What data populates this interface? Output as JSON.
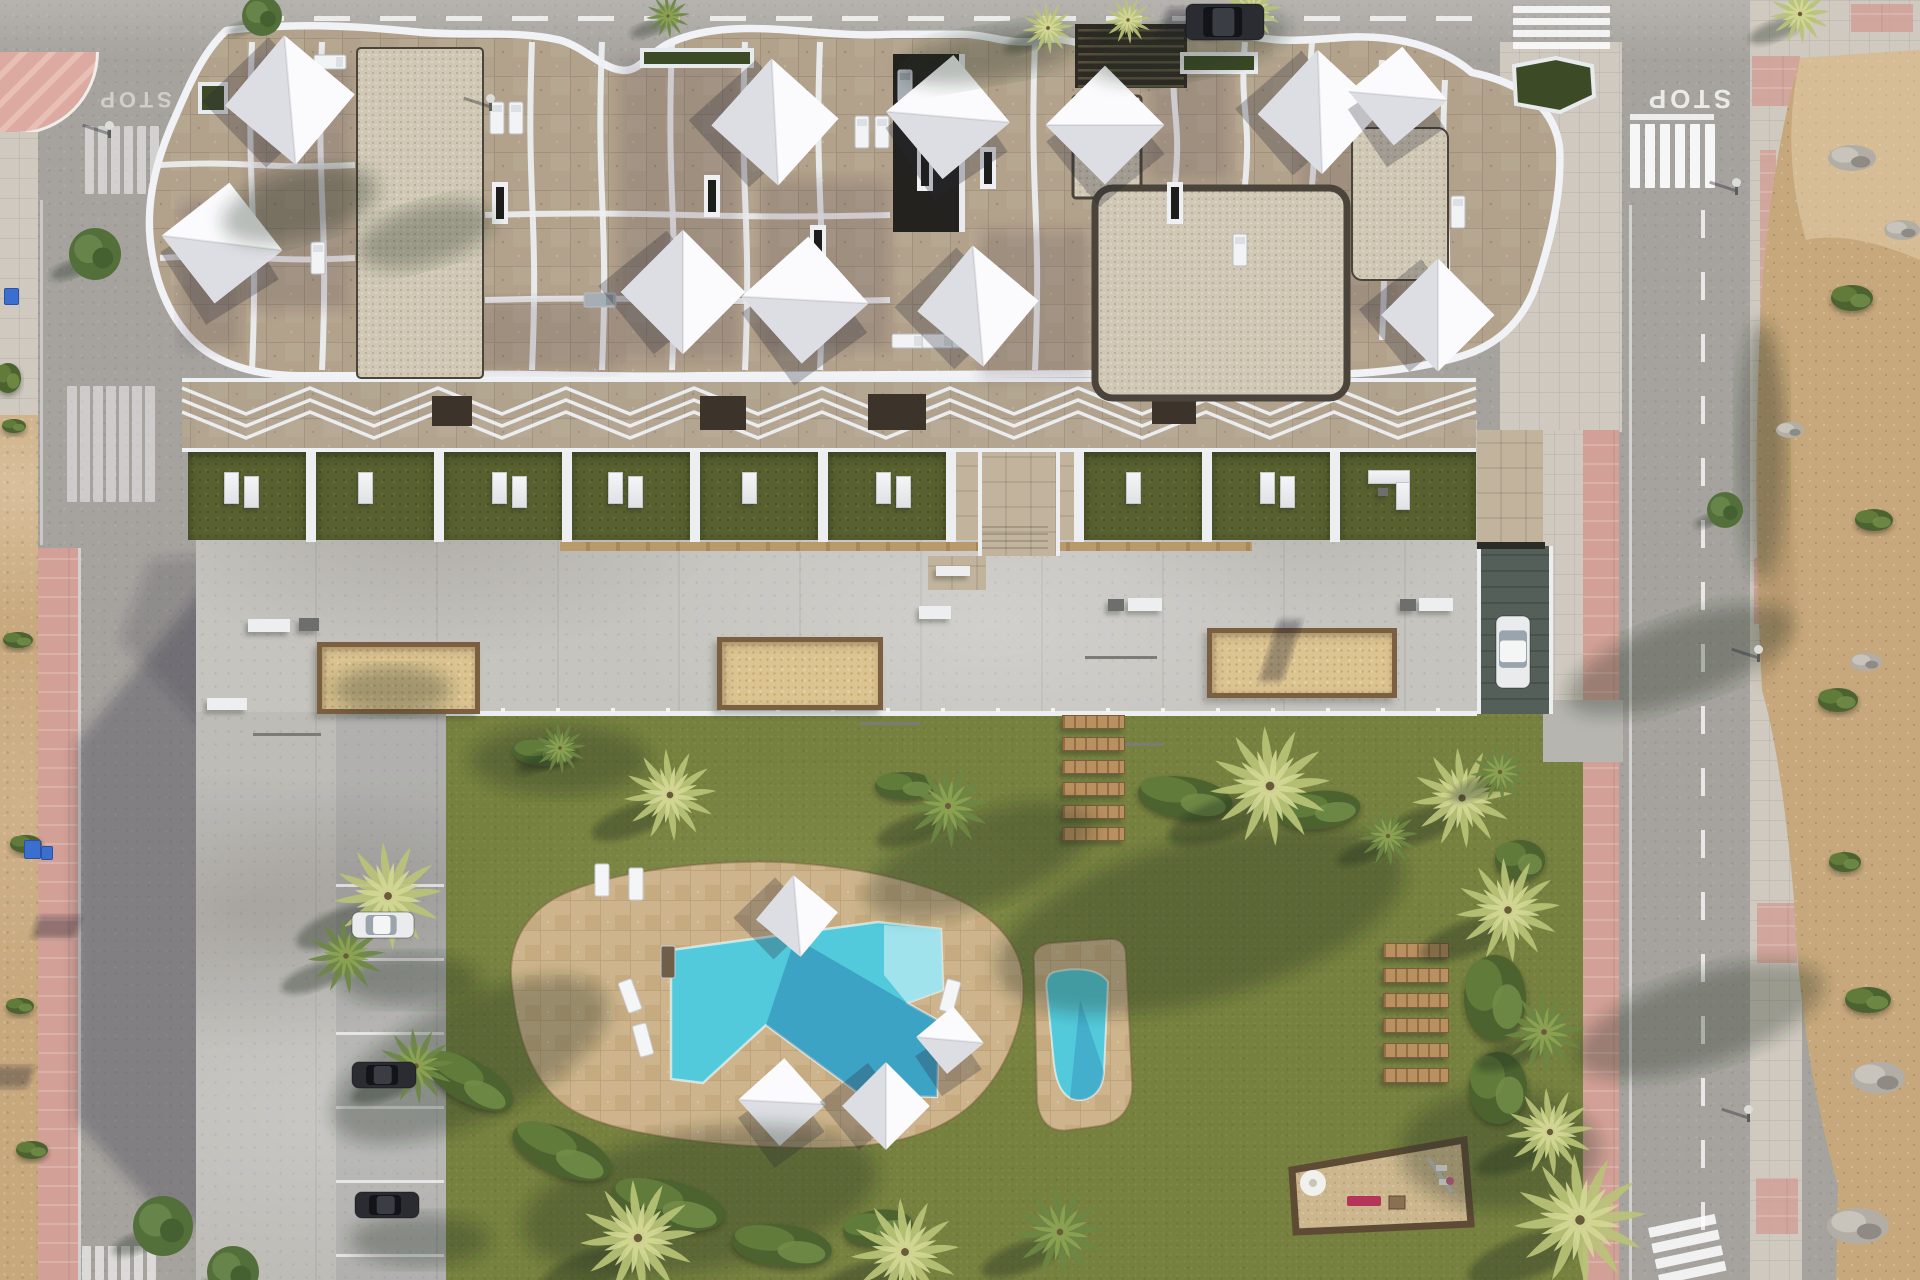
{
  "scene": {
    "title": "Aerial top-down architectural render: apartment building with rooftop terraces, communal garden, pools, petanque courts, parking and perimeter streets",
    "time_of_day": "sunny, shadows cast to lower-left"
  },
  "palette": {
    "asphalt": "#a6a39e",
    "deck_concrete": "#c6c4bf",
    "stone_terrace": "#b2a28b",
    "gravel": "#d0c8b5",
    "lawn": "#76813f",
    "private_garden": "#586030",
    "pool_water": "#53cadb",
    "pool_water_shadow": "#1f6da8",
    "pool_shallow": "#a9e6ee",
    "pool_deck": "#cdb48c",
    "pink_sidewalk": "#d2a096",
    "pale_sidewalk": "#cfc9c0",
    "dirt": "#c7a87c",
    "wood": "#b9905f",
    "parapet_white": "#f0f2f5",
    "sail_white": "#fbfbfd",
    "court_sand": "#dcc491",
    "playground_sand": "#ccb68d"
  },
  "roads": {
    "stop_marking": "STOP",
    "stops": [
      {
        "x": 134,
        "y": 92,
        "rot": 180,
        "size": 22,
        "op": 0.55
      },
      {
        "x": 1688,
        "y": 90,
        "rot": 180,
        "size": 26,
        "op": 0.9
      }
    ],
    "dashes_top": {
      "y": 16,
      "x0": 248,
      "x1": 1490,
      "w": 36,
      "h": 5,
      "gap": 30,
      "op": 0.75
    },
    "dashes_right": {
      "x": 1701,
      "y0": 210,
      "y1": 1225,
      "w": 4,
      "h": 28,
      "gap": 34,
      "op": 0.75
    },
    "edge_lines": [
      {
        "x": 1629,
        "y": 205,
        "w": 3,
        "h": 1075,
        "op": 0.5
      },
      {
        "x": 229,
        "y": 430,
        "w": 3,
        "h": 850,
        "op": 0.35
      },
      {
        "x": 40,
        "y": 200,
        "w": 3,
        "h": 345,
        "op": 0.4
      },
      {
        "x": 1630,
        "y": 114,
        "w": 84,
        "h": 6,
        "op": 0.8
      }
    ],
    "crosswalks": [
      {
        "x": 85,
        "y": 126,
        "n": 6,
        "w": 9,
        "h": 68,
        "gap": 4,
        "vert": true,
        "op": 0.5,
        "rot": 0
      },
      {
        "x": 67,
        "y": 386,
        "n": 7,
        "w": 10,
        "h": 116,
        "gap": 3,
        "vert": true,
        "op": 0.45,
        "rot": 0
      },
      {
        "x": 82,
        "y": 1246,
        "n": 6,
        "w": 9,
        "h": 34,
        "gap": 4,
        "vert": true,
        "op": 0.6,
        "rot": 0
      },
      {
        "x": 1630,
        "y": 124,
        "n": 6,
        "w": 10,
        "h": 64,
        "gap": 5,
        "vert": true,
        "op": 0.9,
        "rot": 0
      },
      {
        "x": 1513,
        "y": 6,
        "n": 4,
        "w": 97,
        "h": 7,
        "gap": 5,
        "vert": false,
        "op": 0.85,
        "rot": 0
      },
      {
        "x": 1648,
        "y": 1228,
        "n": 4,
        "w": 68,
        "h": 10,
        "gap": 6,
        "vert": false,
        "op": 0.85,
        "rot": -12
      }
    ]
  },
  "building": {
    "gravel_patches": [
      {
        "x": 357,
        "y": 48,
        "w": 126,
        "h": 330,
        "r": 4,
        "border": 2
      },
      {
        "x": 1073,
        "y": 96,
        "w": 68,
        "h": 102,
        "r": 3,
        "border": 3
      },
      {
        "x": 1095,
        "y": 188,
        "w": 252,
        "h": 210,
        "r": 18,
        "border": 7
      },
      {
        "x": 1352,
        "y": 128,
        "w": 96,
        "h": 152,
        "r": 10,
        "border": 2
      }
    ],
    "shade_quads": [
      [
        250,
        60,
        100,
        250
      ],
      [
        620,
        60,
        120,
        300
      ],
      [
        760,
        180,
        130,
        170
      ],
      [
        1150,
        60,
        80,
        120
      ],
      [
        1300,
        120,
        100,
        200
      ],
      [
        420,
        300,
        200,
        70
      ],
      [
        180,
        200,
        60,
        150
      ],
      [
        980,
        230,
        110,
        150
      ]
    ],
    "wavy_walls_x": [
      252,
      322,
      532,
      602,
      672,
      745,
      820,
      1035,
      1105,
      1175,
      1245,
      1312,
      1382,
      1445
    ],
    "wavy_walls_h": [
      [
        252,
        42,
        370
      ],
      [
        322,
        42,
        370
      ],
      [
        532,
        42,
        370
      ],
      [
        602,
        42,
        370
      ],
      [
        672,
        42,
        370
      ],
      [
        745,
        42,
        370
      ],
      [
        820,
        42,
        370
      ],
      [
        1035,
        42,
        370
      ],
      [
        1105,
        42,
        185
      ],
      [
        1175,
        42,
        185
      ],
      [
        1245,
        42,
        185
      ],
      [
        1312,
        42,
        185
      ],
      [
        1382,
        60,
        340
      ],
      [
        1445,
        80,
        330
      ]
    ],
    "horiz_walls": [
      [
        160,
        355,
        165
      ],
      [
        160,
        355,
        258
      ],
      [
        485,
        890,
        215
      ],
      [
        485,
        890,
        300
      ]
    ],
    "roof_sails": [
      [
        290,
        100,
        92,
        40
      ],
      [
        222,
        243,
        86,
        -38
      ],
      [
        775,
        122,
        90,
        42
      ],
      [
        948,
        117,
        88,
        -40
      ],
      [
        683,
        292,
        88,
        45
      ],
      [
        805,
        300,
        90,
        -42
      ],
      [
        978,
        306,
        86,
        40
      ],
      [
        1105,
        125,
        84,
        -45
      ],
      [
        1320,
        112,
        88,
        43
      ],
      [
        1398,
        96,
        70,
        -40
      ],
      [
        1438,
        315,
        80,
        45
      ]
    ],
    "roof_loungers": [
      [
        497,
        118,
        0,
        0
      ],
      [
        516,
        118,
        0,
        0
      ],
      [
        862,
        132,
        0,
        0
      ],
      [
        882,
        132,
        0,
        0
      ],
      [
        905,
        86,
        0,
        1
      ],
      [
        938,
        135,
        90,
        0
      ],
      [
        908,
        341,
        90,
        0
      ],
      [
        938,
        341,
        90,
        0
      ],
      [
        968,
        341,
        90,
        0
      ],
      [
        1240,
        250,
        0,
        0
      ],
      [
        1458,
        212,
        0,
        0
      ],
      [
        318,
        258,
        0,
        0
      ],
      [
        330,
        62,
        90,
        0
      ],
      [
        600,
        300,
        90,
        1
      ]
    ],
    "skylights": [
      [
        712,
        196
      ],
      [
        925,
        170
      ],
      [
        988,
        168
      ],
      [
        1175,
        203
      ],
      [
        500,
        203
      ],
      [
        818,
        246
      ]
    ],
    "tower": {
      "x": 893,
      "y": 54,
      "w": 72,
      "h": 178
    },
    "roof_pergola": {
      "x": 1075,
      "y": 24,
      "w": 112,
      "h": 64
    },
    "hedges": [
      {
        "pts": "1514,66 1556,58 1592,66 1594,96 1560,112 1516,104"
      },
      {
        "pts": "200,84 226,84 226,112 200,112"
      },
      {
        "pts": "642,50 752,50 752,66 642,66"
      },
      {
        "pts": "1182,54 1256,54 1256,72 1182,72"
      }
    ]
  },
  "amenities": {
    "cells": {
      "x0": 188,
      "w": 118,
      "gap": 10,
      "y": 452,
      "h": 88,
      "n": 9,
      "entrance_index": 6
    },
    "big_cell": {
      "x": 1340,
      "y": 452,
      "w": 136,
      "h": 88
    },
    "beam_band": {
      "x0": 182,
      "x1": 1476,
      "y_top": 388,
      "y_bot": 450,
      "cell": 128,
      "rows": 3,
      "row_dy": 12
    },
    "planters": [
      [
        432,
        396,
        40,
        30
      ],
      [
        700,
        396,
        46,
        34
      ],
      [
        868,
        394,
        58,
        36
      ],
      [
        1152,
        394,
        44,
        30
      ]
    ],
    "wood_strip": {
      "x": 560,
      "y": 542,
      "w": 692,
      "h": 9
    },
    "south_wall": {
      "x": 446,
      "y": 711,
      "w": 1031,
      "h": 5
    },
    "entrance": {
      "x": 978,
      "y": 452,
      "w": 74,
      "h": 104,
      "landing": [
        928,
        556,
        58,
        34
      ]
    },
    "courts": [
      [
        317,
        642,
        153,
        62
      ],
      [
        717,
        637,
        156,
        63
      ],
      [
        1207,
        628,
        180,
        60
      ]
    ],
    "benches_white": [
      [
        248,
        619,
        42,
        13
      ],
      [
        207,
        698,
        40,
        12
      ],
      [
        919,
        606,
        32,
        13
      ],
      [
        1128,
        598,
        34,
        13
      ],
      [
        1419,
        598,
        34,
        13
      ],
      [
        936,
        566,
        34,
        10
      ]
    ],
    "benches_dark": [
      [
        299,
        618,
        20,
        13
      ],
      [
        1108,
        599,
        16,
        12
      ],
      [
        1400,
        599,
        16,
        12
      ]
    ],
    "rods": [
      [
        860,
        722,
        60,
        3
      ],
      [
        1085,
        656,
        72,
        3
      ],
      [
        1103,
        743,
        60,
        3
      ],
      [
        253,
        733,
        68,
        3
      ]
    ],
    "planks_a": {
      "x": 1062,
      "w": 61,
      "h": 12,
      "ys": [
        715,
        737,
        760,
        782,
        805,
        827
      ]
    },
    "planks_b": {
      "x": 1383,
      "w": 64,
      "h": 13,
      "ys": [
        943,
        968,
        993,
        1018,
        1043,
        1068
      ]
    },
    "playground": {
      "pts": "1292,1170 1464,1140 1471,1224 1296,1232",
      "mushroom": [
        1313,
        1183
      ],
      "bench_red": [
        1347,
        1196,
        34,
        10
      ],
      "box": [
        1389,
        1196,
        16,
        13
      ],
      "swing": {
        "f1": [
          1428,
          1158
        ],
        "f2": [
          1452,
          1192
        ],
        "seats": [
          [
            1436,
            1165
          ],
          [
            1439,
            1179
          ]
        ]
      }
    },
    "pool_sails": [
      [
        797,
        916,
        58,
        40
      ],
      [
        782,
        1102,
        62,
        -42
      ],
      [
        886,
        1106,
        62,
        45
      ],
      [
        950,
        1040,
        48,
        -40
      ]
    ],
    "pool_loungers": [
      [
        630,
        996,
        -20,
        0
      ],
      [
        643,
        1040,
        -15,
        0
      ],
      [
        602,
        880,
        0,
        0
      ],
      [
        636,
        884,
        0,
        0
      ],
      [
        950,
        996,
        15,
        0
      ],
      [
        668,
        962,
        0,
        1
      ]
    ]
  },
  "parking": {
    "area": {
      "x": 196,
      "y": 712,
      "w": 250,
      "h": 568
    },
    "bay_lines": {
      "x": 336,
      "w": 108,
      "ys": [
        884,
        958,
        1032,
        1106,
        1180,
        1254
      ]
    },
    "cars": [
      {
        "x": 352,
        "y": 912,
        "w": 62,
        "h": 26,
        "dir": "h",
        "tone": "white"
      },
      {
        "x": 352,
        "y": 1062,
        "w": 64,
        "h": 26,
        "dir": "h",
        "tone": "dark"
      },
      {
        "x": 355,
        "y": 1192,
        "w": 64,
        "h": 26,
        "dir": "h",
        "tone": "dark"
      }
    ]
  },
  "traffic": {
    "cars": [
      {
        "x": 1186,
        "y": 4,
        "w": 78,
        "h": 36,
        "dir": "h",
        "tone": "dark"
      },
      {
        "x": 1496,
        "y": 616,
        "w": 34,
        "h": 72,
        "dir": "v",
        "tone": "white"
      }
    ]
  },
  "pool": {
    "deck_path": "M512,986 C506,944 528,908 568,892 C612,874 676,864 742,862 C812,860 886,872 940,892 C984,908 1016,936 1022,972 C1028,1012 1012,1062 978,1098 C946,1132 892,1148 820,1148 C744,1148 640,1140 584,1116 C536,1096 518,1044 512,986 Z",
    "water_path": "M671,950 L878,922 L941,929 L943,990 L907,1003 L939,1021 L937,1097 L861,1095 L766,1025 L703,1083 L671,1079 Z",
    "shallow_path": "M884,925 L941,929 L943,990 L907,1003 L884,975 Z",
    "water_shadow_path": "M795,938 L907,1003 L939,1021 L937,1097 L861,1095 L766,1025 Z",
    "small_deck_path": "M1034,962 C1032,950 1040,944 1052,943 L1108,939 C1120,938 1126,944 1126,956 L1132,1080 C1134,1106 1122,1122 1100,1126 L1070,1130 C1050,1133 1040,1122 1037,1102 Z",
    "small_water_path": "M1054,972 C1080,966 1100,970 1108,982 L1104,1072 C1102,1098 1082,1104 1070,1098 C1060,1092 1056,1080 1054,1064 L1047,992 C1045,980 1048,974 1054,972 Z"
  },
  "vegetation": {
    "palms": [
      [
        262,
        16,
        20,
        "t"
      ],
      [
        668,
        16,
        22,
        "g"
      ],
      [
        1048,
        28,
        26,
        "y"
      ],
      [
        1252,
        10,
        30,
        "y"
      ],
      [
        1800,
        14,
        30,
        "y"
      ],
      [
        1128,
        20,
        24,
        "y"
      ],
      [
        95,
        254,
        26,
        "t"
      ],
      [
        1725,
        510,
        18,
        "t"
      ],
      [
        560,
        748,
        26,
        "g"
      ],
      [
        670,
        795,
        46,
        "y"
      ],
      [
        948,
        806,
        42,
        "g"
      ],
      [
        1270,
        786,
        60,
        "y"
      ],
      [
        1462,
        798,
        50,
        "y"
      ],
      [
        1388,
        836,
        30,
        "g"
      ],
      [
        388,
        896,
        54,
        "y"
      ],
      [
        346,
        956,
        38,
        "g"
      ],
      [
        416,
        1066,
        38,
        "g"
      ],
      [
        638,
        1238,
        58,
        "y"
      ],
      [
        905,
        1252,
        54,
        "y"
      ],
      [
        1060,
        1232,
        46,
        "g"
      ],
      [
        1508,
        910,
        52,
        "y"
      ],
      [
        1544,
        1032,
        40,
        "g"
      ],
      [
        1550,
        1132,
        44,
        "y"
      ],
      [
        1580,
        1220,
        66,
        "y"
      ],
      [
        1500,
        772,
        30,
        "g"
      ],
      [
        163,
        1226,
        30,
        "t"
      ],
      [
        233,
        1272,
        26,
        "t"
      ]
    ],
    "bushes": [
      [
        470,
        1082,
        95,
        42,
        28
      ],
      [
        562,
        1152,
        105,
        46,
        22
      ],
      [
        668,
        1205,
        115,
        48,
        12
      ],
      [
        782,
        1246,
        100,
        42,
        6
      ],
      [
        878,
        1228,
        70,
        36,
        -8
      ],
      [
        1185,
        798,
        95,
        42,
        8
      ],
      [
        1318,
        810,
        85,
        38,
        -6
      ],
      [
        905,
        786,
        60,
        28,
        0
      ],
      [
        545,
        752,
        64,
        28,
        0
      ],
      [
        1495,
        998,
        62,
        86,
        0
      ],
      [
        1498,
        1088,
        58,
        72,
        0
      ],
      [
        1520,
        860,
        50,
        40,
        0
      ],
      [
        1852,
        298,
        42,
        26,
        0
      ],
      [
        1874,
        520,
        38,
        22,
        0
      ],
      [
        1838,
        700,
        40,
        24,
        0
      ],
      [
        1868,
        1000,
        46,
        26,
        0
      ],
      [
        1845,
        862,
        32,
        20,
        0
      ],
      [
        18,
        640,
        30,
        16,
        0
      ],
      [
        26,
        844,
        32,
        18,
        0
      ],
      [
        20,
        1006,
        28,
        16,
        0
      ],
      [
        32,
        1150,
        32,
        18,
        0
      ],
      [
        14,
        426,
        24,
        14,
        0
      ],
      [
        8,
        378,
        26,
        30,
        0
      ]
    ],
    "rubble": [
      [
        1852,
        158,
        48,
        26
      ],
      [
        1878,
        1078,
        54,
        32
      ],
      [
        1858,
        1226,
        62,
        36
      ],
      [
        1790,
        430,
        28,
        16
      ],
      [
        1866,
        662,
        32,
        18
      ],
      [
        1902,
        230,
        36,
        20
      ]
    ]
  },
  "street_furniture": {
    "lamps": [
      [
        108,
        126
      ],
      [
        489,
        99
      ],
      [
        1735,
        183
      ],
      [
        1757,
        650
      ],
      [
        1747,
        1110
      ]
    ],
    "bins": [
      [
        4,
        288,
        13,
        15
      ],
      [
        24,
        840,
        15,
        17
      ],
      [
        41,
        846,
        10,
        12
      ]
    ],
    "pink_patches": [
      [
        1752,
        56,
        48,
        50
      ],
      [
        1760,
        150,
        16,
        250
      ],
      [
        1754,
        558,
        40,
        66
      ],
      [
        1757,
        903,
        40,
        60
      ],
      [
        1756,
        1178,
        42,
        56
      ],
      [
        1851,
        4,
        62,
        28
      ]
    ]
  },
  "soft_shadows": [
    [
      470,
      1060,
      150,
      60,
      -25
    ],
    [
      1200,
      920,
      210,
      80,
      -15
    ],
    [
      700,
      1200,
      180,
      70,
      -10
    ],
    [
      980,
      860,
      120,
      45,
      -20
    ],
    [
      1500,
      1150,
      100,
      60,
      0
    ],
    [
      560,
      760,
      90,
      35,
      0
    ],
    [
      392,
      690,
      60,
      24,
      0
    ],
    [
      410,
      980,
      70,
      26,
      0
    ],
    [
      420,
      1240,
      70,
      26,
      0
    ],
    [
      300,
      205,
      80,
      34,
      -15
    ],
    [
      425,
      235,
      70,
      30,
      -15
    ],
    [
      990,
      55,
      90,
      26,
      -10
    ],
    [
      1190,
      48,
      100,
      28,
      -12
    ],
    [
      1680,
      660,
      120,
      40,
      -20
    ],
    [
      1700,
      1020,
      130,
      45,
      -18
    ],
    [
      1762,
      450,
      24,
      130,
      0
    ]
  ]
}
